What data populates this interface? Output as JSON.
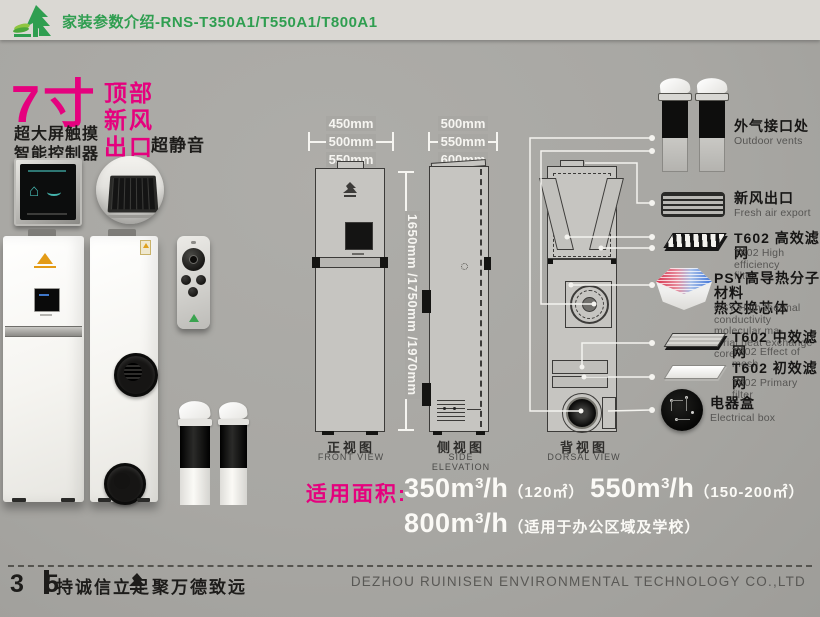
{
  "header": {
    "title": "家装参数介绍-RNS-T350A1/T550A1/T800A1",
    "logo_icon": "ruinisen-tree-logo"
  },
  "features": {
    "size": "7寸",
    "screen1": "超大屏触摸",
    "screen2": "智能控制器",
    "top1": "顶部",
    "top2": "新风",
    "top3": "出口",
    "quiet": "超静音"
  },
  "views": {
    "front": {
      "cn": "正视图",
      "en": "FRONT VIEW",
      "w1": "450mm",
      "w2": "500mm",
      "w3": "550mm"
    },
    "side": {
      "cn": "侧视图",
      "en": "SIDE ELEVATION",
      "w1": "500mm",
      "w2": "550mm",
      "w3": "600mm"
    },
    "back": {
      "cn": "背视图",
      "en": "DORSAL VIEW"
    },
    "height": "1650mm /1750mm /1970mm"
  },
  "components": [
    {
      "cn": "外气接口处",
      "en": "Outdoor vents",
      "icon": "outdoor-vent-pipes"
    },
    {
      "cn": "新风出口",
      "en": "Fresh air export",
      "icon": "fresh-air-grille"
    },
    {
      "cn": "T602 高效滤网",
      "en": "T602 High efficiency\nfilter",
      "icon": "hepa-filter-slab"
    },
    {
      "cn": "PSY高导热分子材料\n热交换芯体",
      "en": "PSY High thermal\nconductivity molecular ma-\nterial heat exchange core",
      "icon": "psy-heat-exchange-core"
    },
    {
      "cn": "T602 中效滤网",
      "en": "T602 Effect of mesh",
      "icon": "mid-filter-slab"
    },
    {
      "cn": "T602 初效滤网",
      "en": "T602 Primary filter",
      "icon": "primary-filter-slab"
    },
    {
      "cn": "电器盒",
      "en": "Electrical box",
      "icon": "electrical-box-pcb"
    }
  ],
  "coverage": {
    "label": "适用面积:",
    "i1": {
      "base": "350m",
      "sup": "3",
      "unit": "/h",
      "note": "（120㎡）"
    },
    "i2": {
      "base": "550m",
      "sup": "3",
      "unit": "/h",
      "note": "（150-200㎡）"
    },
    "i3": {
      "base": "800m",
      "sup": "3",
      "unit": "/h",
      "note": "（适用于办公区域及学校）"
    }
  },
  "footer": {
    "page": "3 5",
    "slogan1": "持诚信立足",
    "slogan2": "聚万德致远",
    "logo_icon": "ruinisen-mark-dark",
    "company": "DEZHOU RUINISEN ENVIRONMENTAL TECHNOLOGY CO.,LTD"
  },
  "colors": {
    "accent_magenta": "#e5017e",
    "brand_green": "#2f9e50",
    "background": "#a8a7a3",
    "header_bar": "#dad8d3"
  }
}
